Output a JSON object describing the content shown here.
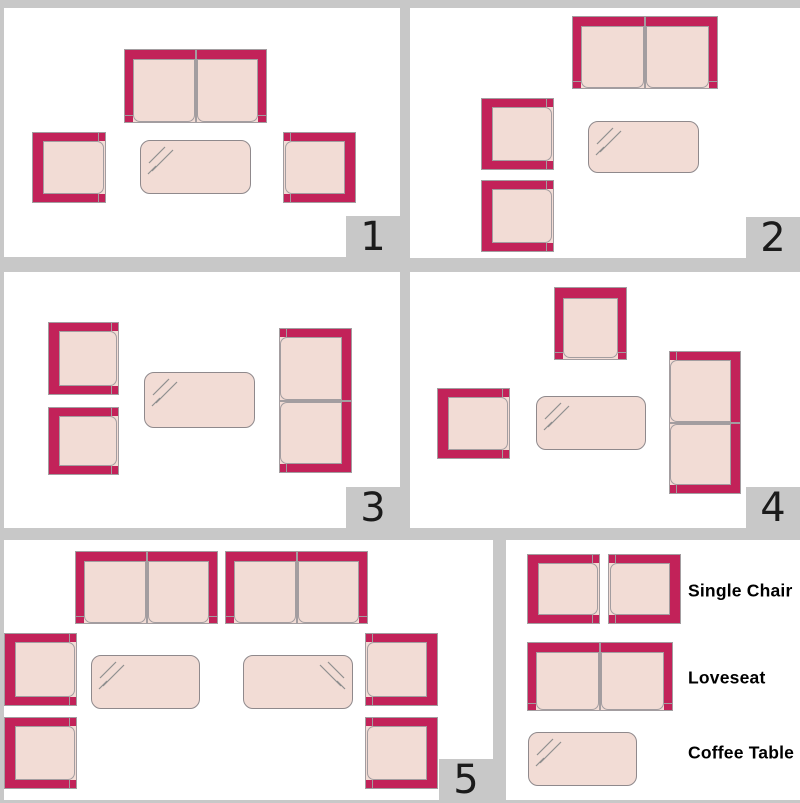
{
  "colors": {
    "background": "#c8c8c8",
    "panel": "#ffffff",
    "furniture_frame": "#c22259",
    "furniture_fill": "#f2dcd5",
    "outline_gray": "#8f898c",
    "number_text": "#1b1b1b"
  },
  "panels": [
    {
      "number": "1",
      "x": 4,
      "y": 8,
      "w": 396,
      "h": 249,
      "pieces": [
        {
          "type": "loveseat",
          "facing": "down",
          "x": 120,
          "y": 41,
          "w": 143,
          "h": 74
        },
        {
          "type": "chair",
          "facing": "right",
          "x": 28,
          "y": 124,
          "w": 74,
          "h": 71
        },
        {
          "type": "table",
          "shine": "tl",
          "x": 136,
          "y": 132,
          "w": 111,
          "h": 54
        },
        {
          "type": "chair",
          "facing": "left",
          "x": 279,
          "y": 124,
          "w": 73,
          "h": 71
        }
      ]
    },
    {
      "number": "2",
      "x": 410,
      "y": 8,
      "w": 390,
      "h": 250,
      "pieces": [
        {
          "type": "loveseat",
          "facing": "down",
          "x": 162,
          "y": 8,
          "w": 146,
          "h": 73
        },
        {
          "type": "chair",
          "facing": "right",
          "x": 71,
          "y": 90,
          "w": 73,
          "h": 72
        },
        {
          "type": "chair",
          "facing": "right",
          "x": 71,
          "y": 172,
          "w": 73,
          "h": 72
        },
        {
          "type": "table",
          "shine": "tl",
          "x": 178,
          "y": 113,
          "w": 111,
          "h": 52
        }
      ]
    },
    {
      "number": "3",
      "x": 4,
      "y": 272,
      "w": 396,
      "h": 256,
      "pieces": [
        {
          "type": "chair",
          "facing": "right",
          "x": 44,
          "y": 50,
          "w": 71,
          "h": 73
        },
        {
          "type": "chair",
          "facing": "right",
          "x": 44,
          "y": 135,
          "w": 71,
          "h": 68
        },
        {
          "type": "table",
          "shine": "tl",
          "x": 140,
          "y": 100,
          "w": 111,
          "h": 56
        },
        {
          "type": "loveseat",
          "facing": "left",
          "x": 275,
          "y": 56,
          "w": 73,
          "h": 145
        }
      ]
    },
    {
      "number": "4",
      "x": 410,
      "y": 272,
      "w": 390,
      "h": 256,
      "pieces": [
        {
          "type": "chair",
          "facing": "down",
          "x": 144,
          "y": 15,
          "w": 73,
          "h": 73
        },
        {
          "type": "chair",
          "facing": "right",
          "x": 27,
          "y": 116,
          "w": 73,
          "h": 71
        },
        {
          "type": "table",
          "shine": "tl",
          "x": 126,
          "y": 124,
          "w": 110,
          "h": 54
        },
        {
          "type": "loveseat",
          "facing": "left",
          "x": 259,
          "y": 79,
          "w": 72,
          "h": 143
        }
      ]
    },
    {
      "number": "5",
      "x": 4,
      "y": 540,
      "w": 489,
      "h": 260,
      "pieces": [
        {
          "type": "loveseat",
          "facing": "down",
          "x": 71,
          "y": 11,
          "w": 143,
          "h": 73
        },
        {
          "type": "loveseat",
          "facing": "down",
          "x": 221,
          "y": 11,
          "w": 143,
          "h": 73
        },
        {
          "type": "chair",
          "facing": "right",
          "x": 0,
          "y": 93,
          "w": 73,
          "h": 73
        },
        {
          "type": "chair",
          "facing": "right",
          "x": 0,
          "y": 177,
          "w": 73,
          "h": 72
        },
        {
          "type": "table",
          "shine": "tl",
          "x": 87,
          "y": 115,
          "w": 109,
          "h": 54
        },
        {
          "type": "table",
          "shine": "tr",
          "x": 239,
          "y": 115,
          "w": 110,
          "h": 54
        },
        {
          "type": "chair",
          "facing": "left",
          "x": 361,
          "y": 93,
          "w": 73,
          "h": 73
        },
        {
          "type": "chair",
          "facing": "left",
          "x": 361,
          "y": 177,
          "w": 73,
          "h": 72
        }
      ]
    }
  ],
  "legend": {
    "x": 506,
    "y": 540,
    "w": 294,
    "h": 260,
    "items": [
      {
        "label": "Single Chair",
        "label_x": 182,
        "label_cy": 51,
        "pieces": [
          {
            "type": "chair",
            "facing": "right",
            "x": 21,
            "y": 14,
            "w": 73,
            "h": 70
          },
          {
            "type": "chair",
            "facing": "left",
            "x": 102,
            "y": 14,
            "w": 73,
            "h": 70
          }
        ]
      },
      {
        "label": "Loveseat",
        "label_x": 182,
        "label_cy": 138,
        "pieces": [
          {
            "type": "loveseat",
            "facing": "down",
            "x": 21,
            "y": 102,
            "w": 146,
            "h": 69
          }
        ]
      },
      {
        "label": "Coffee Table",
        "label_x": 182,
        "label_cy": 213,
        "pieces": [
          {
            "type": "table",
            "shine": "tl",
            "x": 22,
            "y": 192,
            "w": 109,
            "h": 54
          }
        ]
      }
    ]
  }
}
